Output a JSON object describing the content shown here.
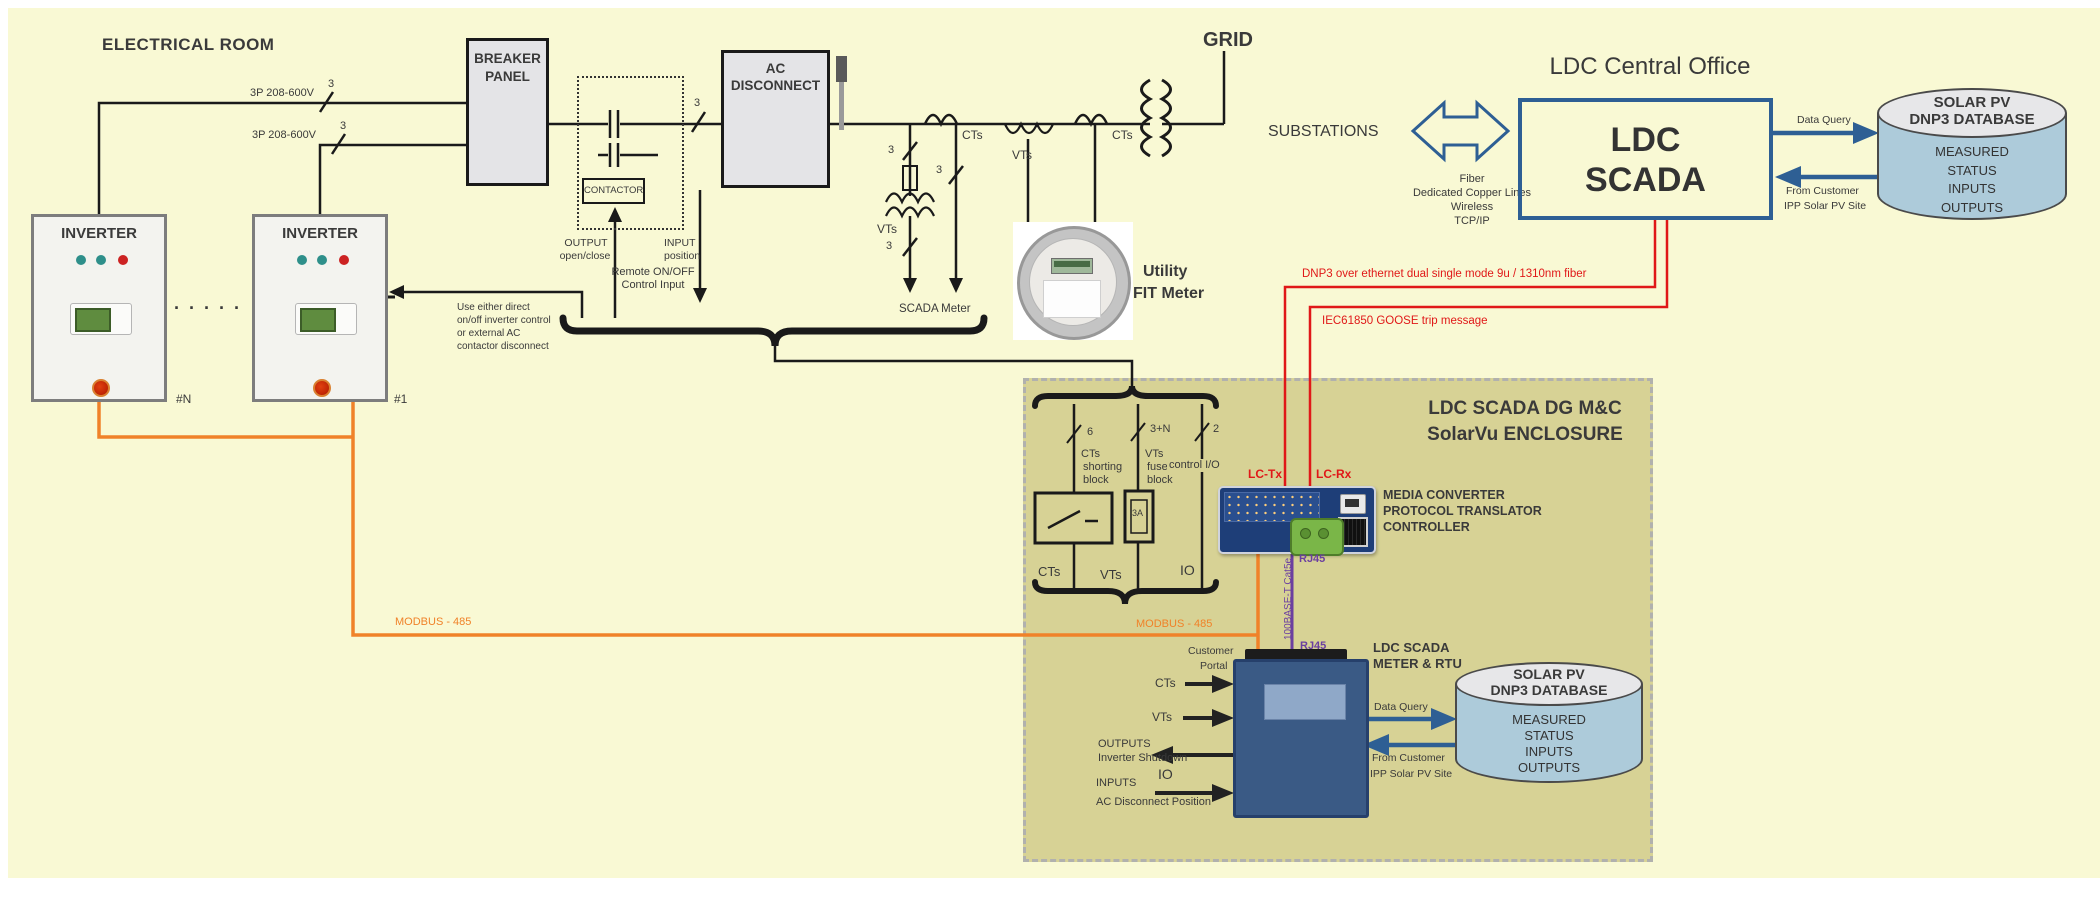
{
  "room": {
    "title": "ELECTRICAL ROOM"
  },
  "inv": {
    "name": "INVERTER",
    "tag_n": "#N",
    "tag_1": "#1",
    "dots": "·  ·  ·  ·  ·"
  },
  "feed": {
    "v": "3P 208-600V",
    "count": "3"
  },
  "bp": {
    "l1": "BREAKER",
    "l2": "PANEL"
  },
  "ctb": {
    "label": "CONTACTOR",
    "out1": "OUTPUT",
    "out2": "open/close",
    "in1": "INPUT",
    "in2": "position"
  },
  "acd": {
    "l1": "AC",
    "l2": "DISCONNECT"
  },
  "remote": {
    "l1": "Remote ON/OFF",
    "l2": "Control Input",
    "n1": "Use either direct",
    "n2": "on/off inverter control",
    "n3": "or external AC",
    "n4": "contactor disconnect"
  },
  "met": {
    "cts1": "CTs",
    "vts1": "VTs",
    "c3": "3",
    "scada": "SCADA Meter",
    "vts2": "VTs",
    "cts2": "CTs",
    "util1": "Utility",
    "util2": "FIT Meter",
    "grid": "GRID"
  },
  "co": {
    "title": "LDC Central Office",
    "subs": "SUBSTATIONS",
    "f1": "Fiber",
    "f2": "Dedicated Copper Lines",
    "f3": "Wireless",
    "f4": "TCP/IP",
    "b1": "LDC",
    "b2": "SCADA",
    "dq": "Data Query",
    "fc1": "From Customer",
    "fc2": "IPP Solar PV Site"
  },
  "db": {
    "t1": "SOLAR PV",
    "t2": "DNP3 DATABASE",
    "i1": "MEASURED",
    "i2": "STATUS",
    "i3": "INPUTS",
    "i4": "OUTPUTS"
  },
  "fiber": {
    "dnp3": "DNP3 over ethernet dual single mode 9u / 1310nm  fiber",
    "goose": "IEC61850 GOOSE trip message",
    "tx": "LC-Tx",
    "rx": "LC-Rx"
  },
  "modbus": "MODBUS - 485",
  "enc": {
    "t1": "LDC SCADA DG M&C",
    "t2": "SolarVu ENCLOSURE",
    "r1c": "6",
    "r1a": "CTs",
    "r1b": "shorting",
    "r1d": "block",
    "r2c": "3+N",
    "r2a": "VTs",
    "r2b": "fused",
    "r2d": "block",
    "r3c": "2",
    "r3a": "control I/O",
    "fuse": "3A",
    "b1": "CTs",
    "b2": "VTs",
    "b3": "IO",
    "mc1": "MEDIA CONVERTER",
    "mc2": "PROTOCOL TRANSLATOR",
    "mc3": "CONTROLLER",
    "rj45": "RJ45",
    "cable": "100BASE-T  Cat5e",
    "mt1": "LDC SCADA",
    "mt2": "METER & RTU",
    "cp1": "Customer",
    "cp2": "Portal",
    "cts": "CTs",
    "vts": "VTs",
    "o1": "OUTPUTS",
    "o2": "Inverter Shutdown",
    "io": "IO",
    "in1": "INPUTS",
    "in2": "AC Disconnect Position",
    "dq": "Data Query",
    "fc1": "From Customer",
    "fc2": "IPP Solar PV Site"
  }
}
